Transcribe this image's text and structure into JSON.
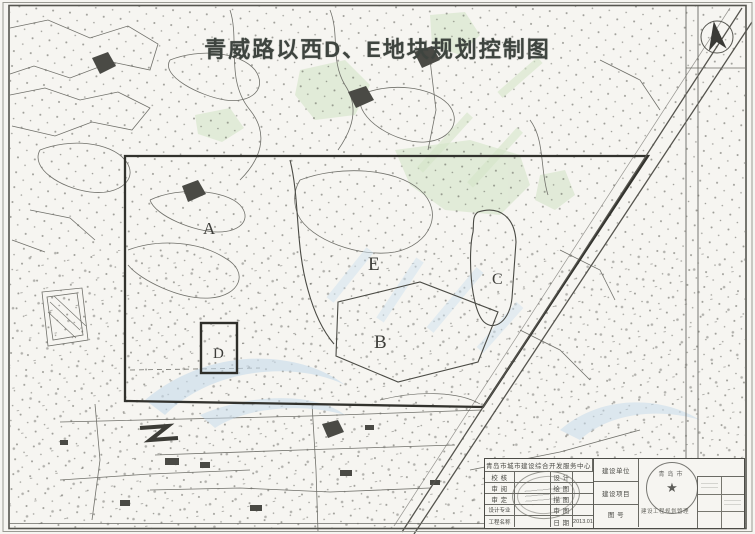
{
  "page": {
    "title": "青威路以西D、E地块规划控制图"
  },
  "map": {
    "block_labels": {
      "A": "A",
      "B": "B",
      "C": "C",
      "D": "D",
      "E": "E"
    }
  },
  "title_block": {
    "org_name": "青岛市城市建设综合开发服务中心",
    "left_rows": [
      {
        "role": "校 核",
        "mid": "设 计",
        "value": ""
      },
      {
        "role": "审 阅",
        "mid": "绘 图",
        "value": ""
      },
      {
        "role": "审 定",
        "mid": "描 图",
        "value": ""
      },
      {
        "role": "设计专业",
        "mid": "审 图",
        "value": ""
      },
      {
        "role": "工程名称",
        "mid": "日 期",
        "value": "2013.01"
      }
    ],
    "right_rows": [
      "建设单位",
      "建设项目",
      "图 号"
    ],
    "note": "建设工程规划管理",
    "seal_text": "青岛市",
    "seal_star": "★"
  },
  "colors": {
    "paper": "#f6f5f1",
    "map_ink": "#70706a",
    "boundary_ink": "#32322d",
    "title_ink": "#3e443f",
    "watermark_blue": "#c6dbeb",
    "watermark_green": "#d5e6c9",
    "stamp_gray": "#6e6e68"
  }
}
